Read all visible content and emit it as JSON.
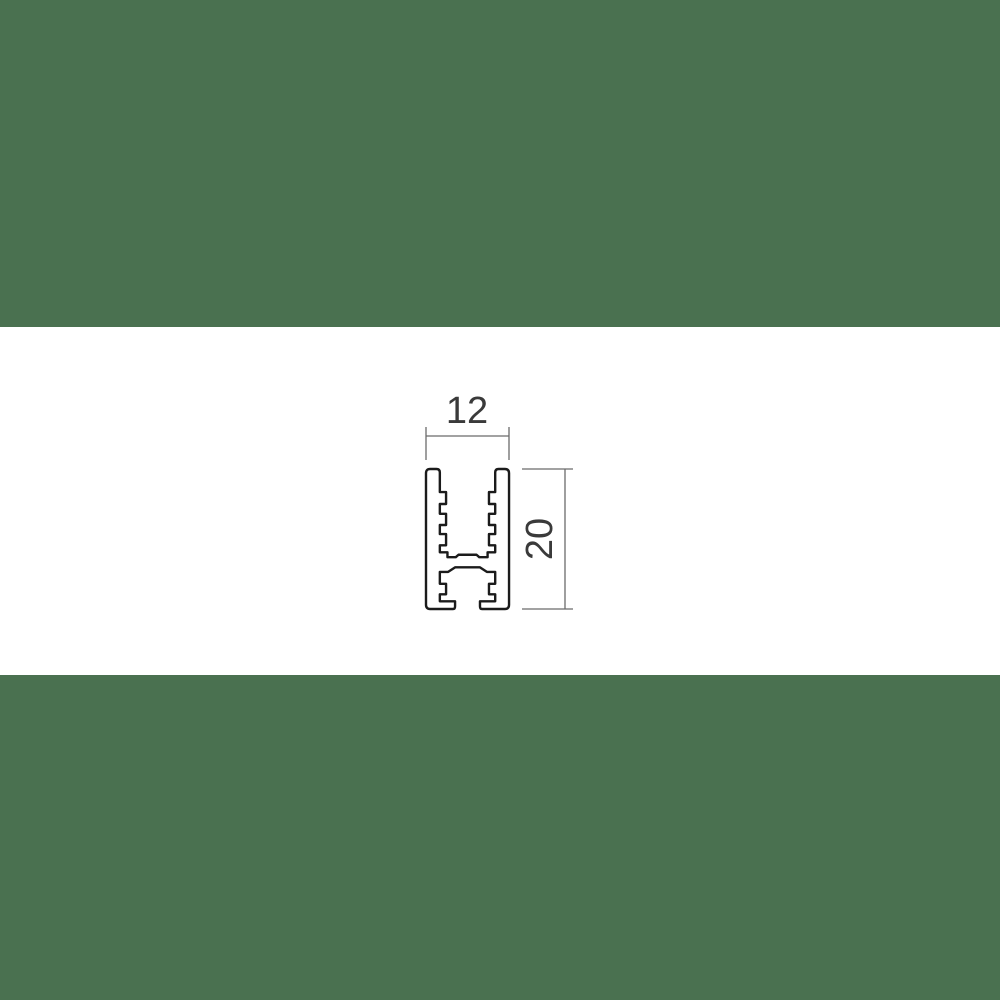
{
  "colors": {
    "band_green": "#4a7150",
    "canvas_white": "#ffffff",
    "profile_line": "#1b1b1b",
    "dimension_line": "#6b6b6b",
    "dimension_text": "#3a3a3a"
  },
  "drawing": {
    "type": "technical-cross-section",
    "subject": "extruded-profile-with-serrated-channels",
    "dimension_width": {
      "value": "12"
    },
    "dimension_height": {
      "value": "20"
    }
  }
}
